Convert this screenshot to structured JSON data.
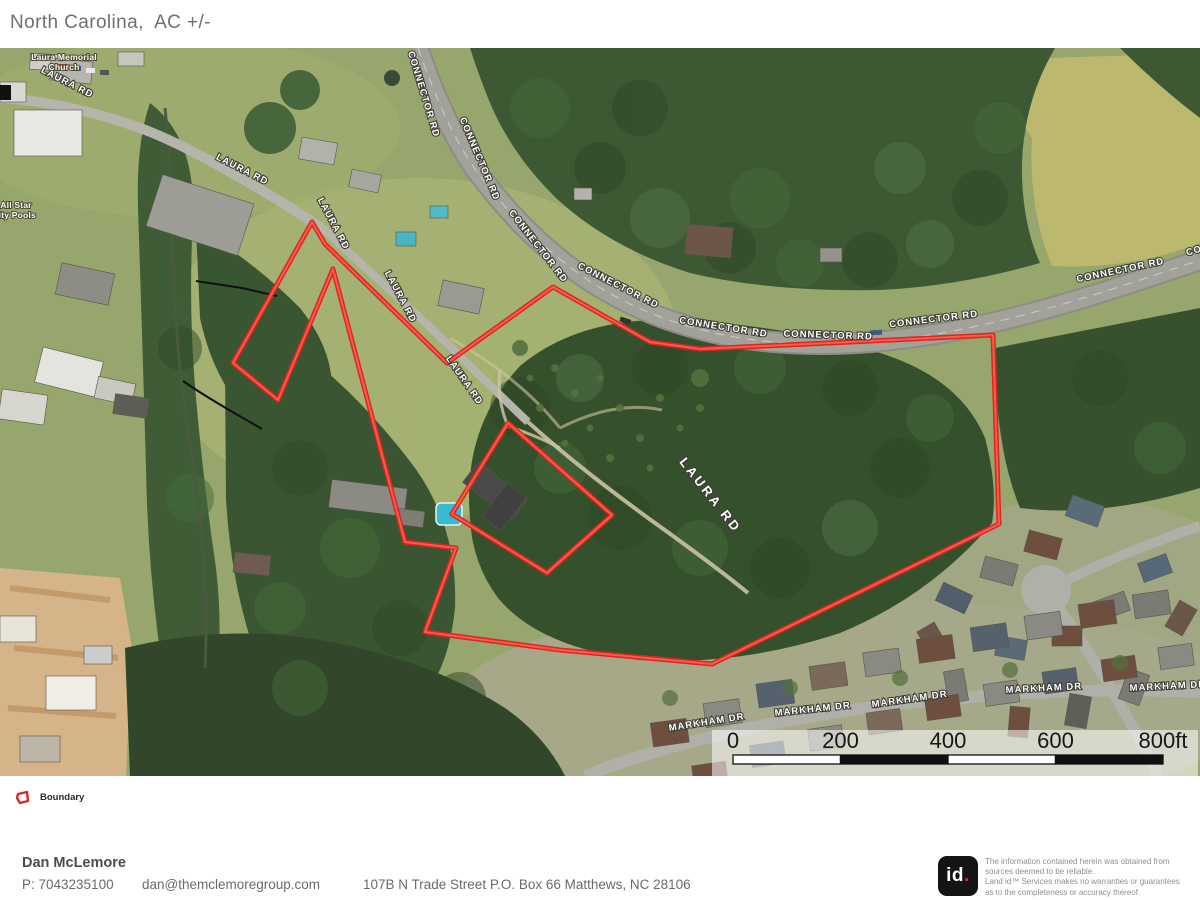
{
  "header": {
    "title": "North Carolina,  AC +/-"
  },
  "map": {
    "road_labels": [
      {
        "text": "CONNECTOR RD",
        "x": 421,
        "y": 47,
        "rot": 73
      },
      {
        "text": "CONNECTOR RD",
        "x": 477,
        "y": 112,
        "rot": 67
      },
      {
        "text": "CONNECTOR RD",
        "x": 536,
        "y": 200,
        "rot": 52
      },
      {
        "text": "CONNECTOR RD",
        "x": 617,
        "y": 240,
        "rot": 27
      },
      {
        "text": "CONNECTOR RD",
        "x": 723,
        "y": 282,
        "rot": 9
      },
      {
        "text": "CONNECTOR RD",
        "x": 828,
        "y": 290,
        "rot": 2
      },
      {
        "text": "CONNECTOR RD",
        "x": 934,
        "y": 274,
        "rot": -7
      },
      {
        "text": "CONNECTOR RD",
        "x": 1121,
        "y": 225,
        "rot": -12
      },
      {
        "text": "CONNECTOR RD",
        "x": 1230,
        "y": 196,
        "rot": -15
      },
      {
        "text": "LAURA RD",
        "x": 66,
        "y": 37,
        "rot": 27
      },
      {
        "text": "LAURA RD",
        "x": 241,
        "y": 124,
        "rot": 27
      },
      {
        "text": "LAURA RD",
        "x": 331,
        "y": 177,
        "rot": 62
      },
      {
        "text": "LAURA RD",
        "x": 398,
        "y": 250,
        "rot": 62
      },
      {
        "text": "LAURA RD",
        "x": 462,
        "y": 334,
        "rot": 55
      },
      {
        "text": "LAURA RD",
        "x": 707,
        "y": 450,
        "rot": 52,
        "size": 13,
        "ls": 3
      },
      {
        "text": "MARKHAM DR",
        "x": 707,
        "y": 677,
        "rot": -9
      },
      {
        "text": "MARKHAM DR",
        "x": 813,
        "y": 664,
        "rot": -6
      },
      {
        "text": "MARKHAM DR",
        "x": 910,
        "y": 654,
        "rot": -8
      },
      {
        "text": "MARKHAM DR",
        "x": 1044,
        "y": 643,
        "rot": -3
      },
      {
        "text": "MARKHAM DR",
        "x": 1168,
        "y": 641,
        "rot": -3
      }
    ],
    "place_labels": [
      {
        "lines": [
          "Laura Memorial",
          "Church"
        ],
        "x": 64,
        "y": 12
      },
      {
        "lines": [
          "All Star",
          "lity Pools"
        ],
        "x": 16,
        "y": 160
      }
    ],
    "scale_bar": {
      "labels": [
        "0",
        "200",
        "400",
        "600",
        "800ft"
      ],
      "x0": 733,
      "step": 107.5,
      "label_y": 700,
      "bar_y": 707,
      "bar_h": 9
    }
  },
  "legend": {
    "items": [
      {
        "label": "Boundary"
      }
    ]
  },
  "colors": {
    "boundary": "#d92723",
    "boundary_inner": "#ff5a49"
  },
  "footer": {
    "name": "Dan McLemore",
    "phone": "P: 7043235100",
    "email": "dan@themclemoregroup.com",
    "address": "107B N Trade Street P.O. Box 66 Matthews, NC 28106"
  },
  "branding": {
    "logo_text": "id",
    "logo_dot": ".",
    "disclaimer_lines": [
      "The information contained herein was obtained from",
      "sources deemed to be reliable.",
      " Land id™ Services makes no warranties or guarantees",
      "as to the completeness or accuracy thereof."
    ]
  }
}
